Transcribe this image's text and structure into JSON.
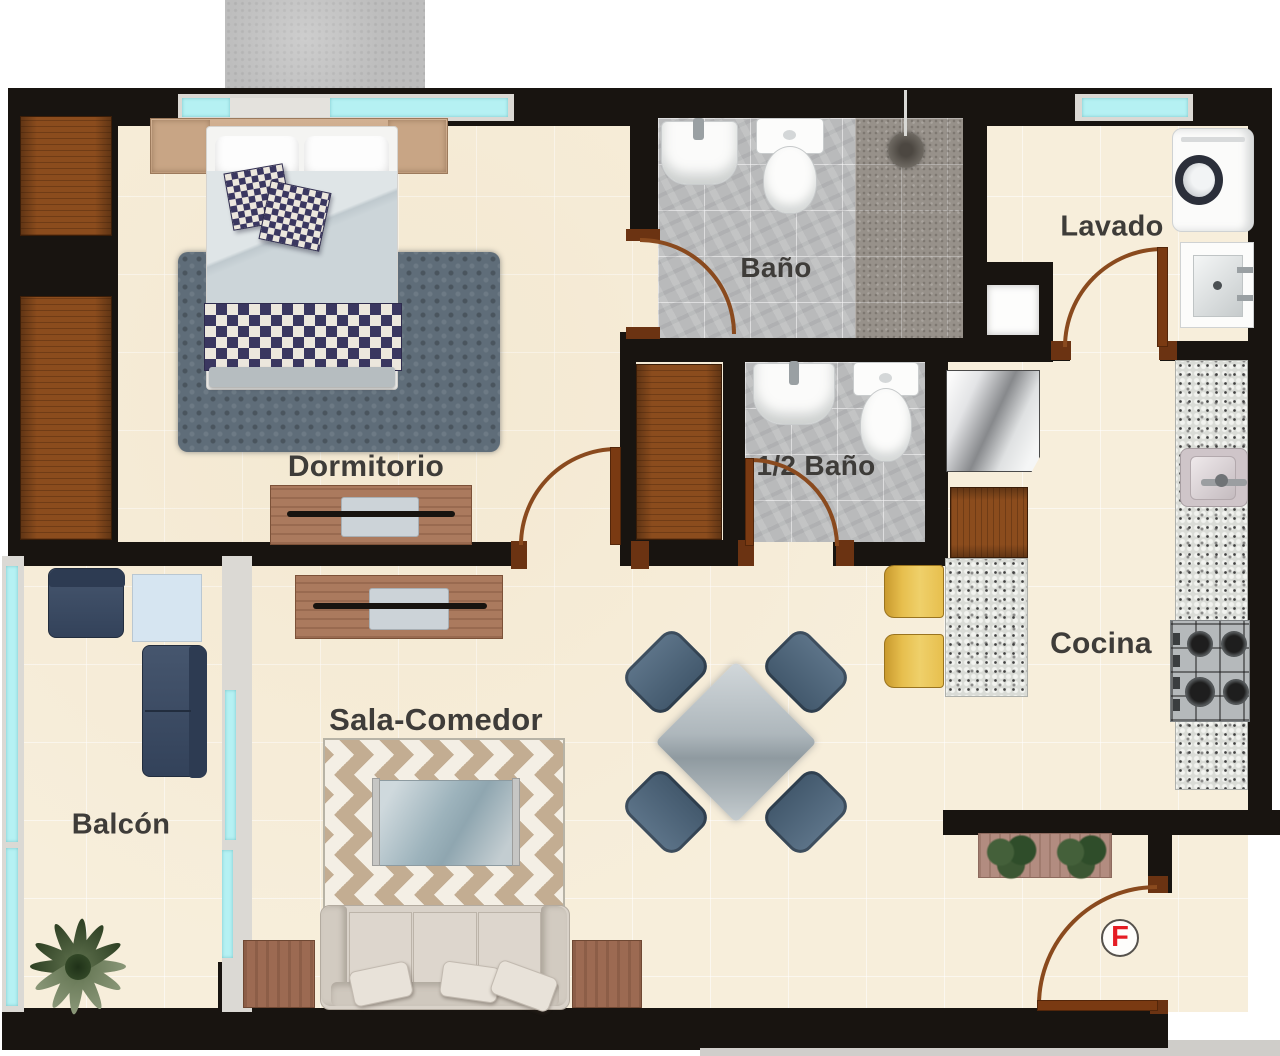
{
  "plan": {
    "rooms": [
      {
        "id": "dormitorio",
        "label": "Dormitorio"
      },
      {
        "id": "bano",
        "label": "Baño"
      },
      {
        "id": "lavado",
        "label": "Lavado"
      },
      {
        "id": "medio-bano",
        "label": "1/2 Baño"
      },
      {
        "id": "cocina",
        "label": "Cocina"
      },
      {
        "id": "sala-comedor",
        "label": "Sala-Comedor"
      },
      {
        "id": "balcon",
        "label": "Balcón"
      }
    ],
    "entrance_marker": {
      "letter": "F"
    },
    "furniture": [
      "double-bed",
      "headboard-nightstands",
      "wardrobe",
      "dresser-tv",
      "shag-rug",
      "bathroom-sink",
      "toilet",
      "shower-head",
      "washing-machine",
      "laundry-sink",
      "wall-niche",
      "refrigerator",
      "kitchen-counter",
      "breakfast-bar",
      "bar-stool",
      "kitchen-sink",
      "gas-stove",
      "half-bath-sink",
      "half-bath-toilet",
      "storage-closet",
      "dining-table",
      "dining-chair",
      "tv-console",
      "chevron-rug",
      "coffee-table",
      "sofa",
      "side-table",
      "balcony-armchair",
      "balcony-side-table",
      "balcony-loveseat",
      "palm-plant",
      "planter-box",
      "entrance-door"
    ],
    "colors": {
      "wall": "#181410",
      "floor_beige": "#f7eedb",
      "bath_tile": "#b9babb",
      "shower_tile": "#97918a",
      "granite": "#d9dbd6",
      "wood_dark": "#8b4c1d",
      "wood_medium": "#ab7a5e",
      "door_brown": "#8a4a1e",
      "window_glass": "#b5f1f3",
      "rug_slate": "#5f6d79",
      "navy_furniture": "#3a4a61",
      "stool_yellow": "#e7bf4e",
      "sofa_greige": "#d9d2c9",
      "chevron_tan": "#c3ad92",
      "marker_red": "#e51c23"
    }
  }
}
